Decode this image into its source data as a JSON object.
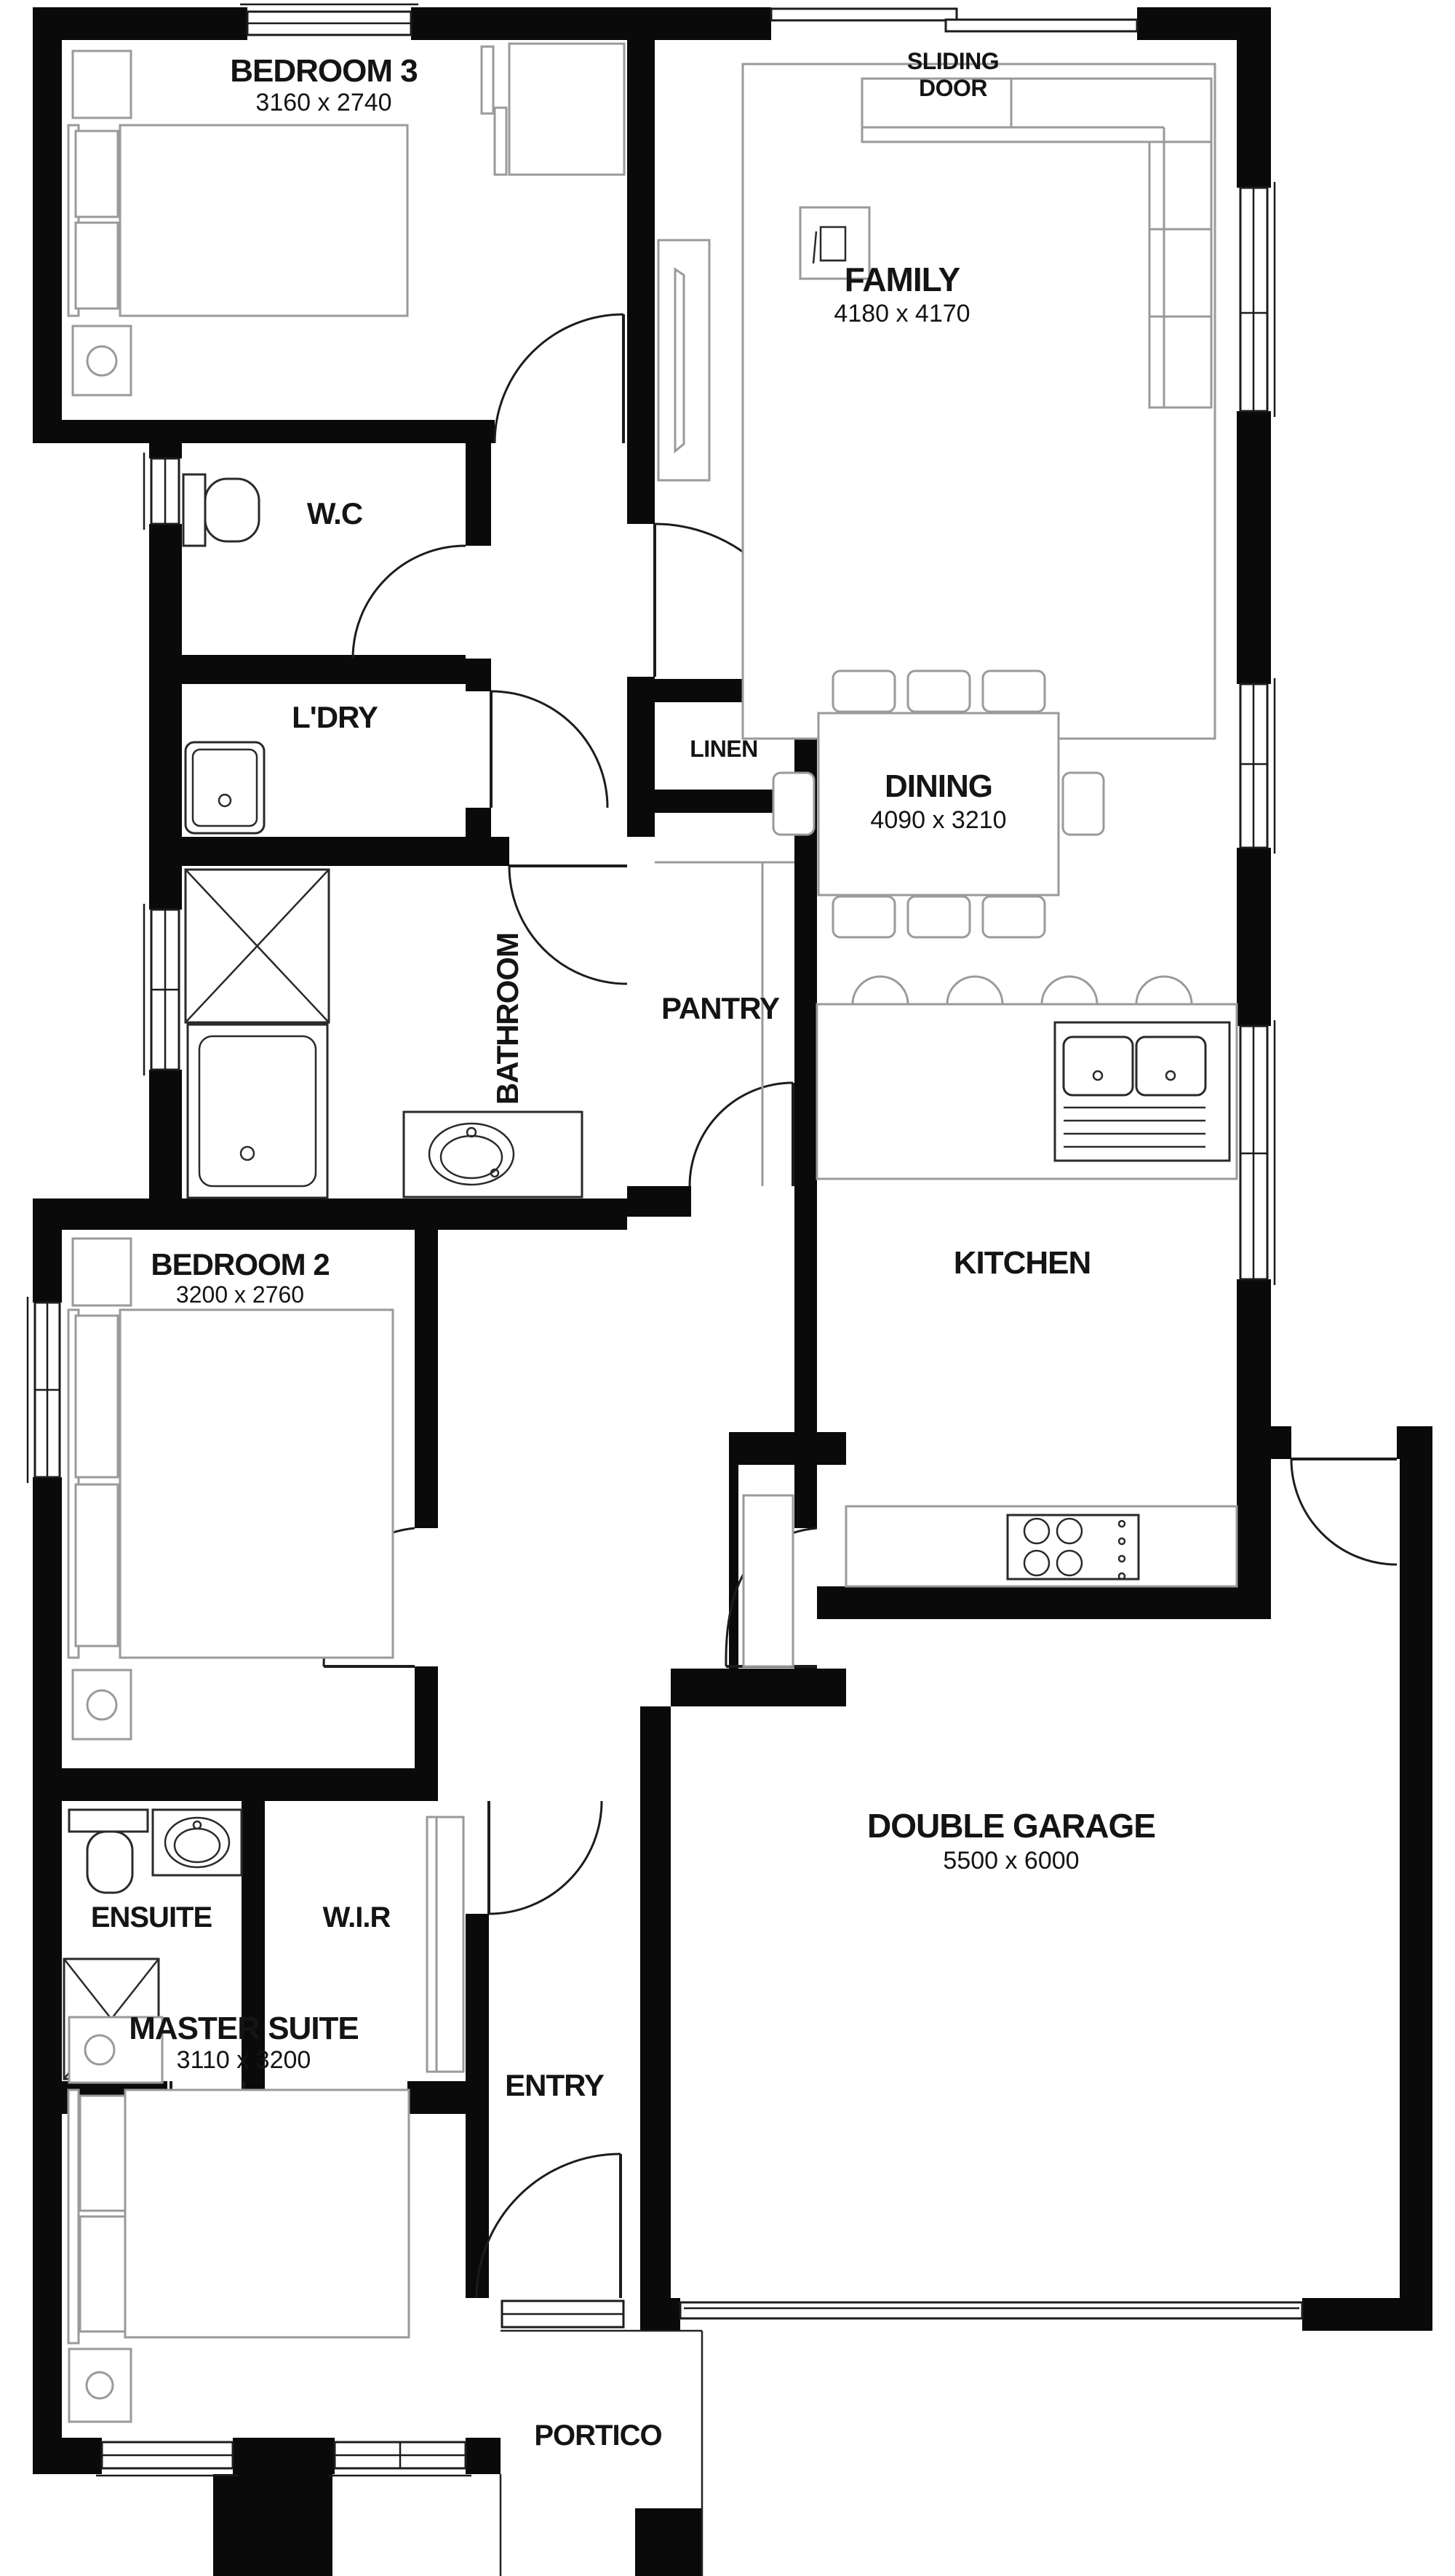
{
  "plan": {
    "colors": {
      "wall": "#0a0a0a",
      "furniture": "#9a9a9a",
      "text": "#141414"
    },
    "rooms": [
      {
        "name": "BEDROOM 3",
        "dims": "3160 x 2740"
      },
      {
        "name": "FAMILY",
        "dims": "4180 x 4170"
      },
      {
        "name": "W.C",
        "dims": ""
      },
      {
        "name": "L'DRY",
        "dims": ""
      },
      {
        "name": "LINEN",
        "dims": ""
      },
      {
        "name": "BATHROOM",
        "dims": ""
      },
      {
        "name": "PANTRY",
        "dims": ""
      },
      {
        "name": "DINING",
        "dims": "4090 x 3210"
      },
      {
        "name": "KITCHEN",
        "dims": ""
      },
      {
        "name": "BEDROOM 2",
        "dims": "3200 x 2760"
      },
      {
        "name": "ENSUITE",
        "dims": ""
      },
      {
        "name": "W.I.R",
        "dims": ""
      },
      {
        "name": "DOUBLE GARAGE",
        "dims": "5500 x 6000"
      },
      {
        "name": "MASTER SUITE",
        "dims": "3110 x 3200"
      },
      {
        "name": "ENTRY",
        "dims": ""
      },
      {
        "name": "PORTICO",
        "dims": ""
      }
    ],
    "annotations": {
      "sliding_door_line1": "SLIDING",
      "sliding_door_line2": "DOOR",
      "magazine_icon": "m"
    }
  }
}
